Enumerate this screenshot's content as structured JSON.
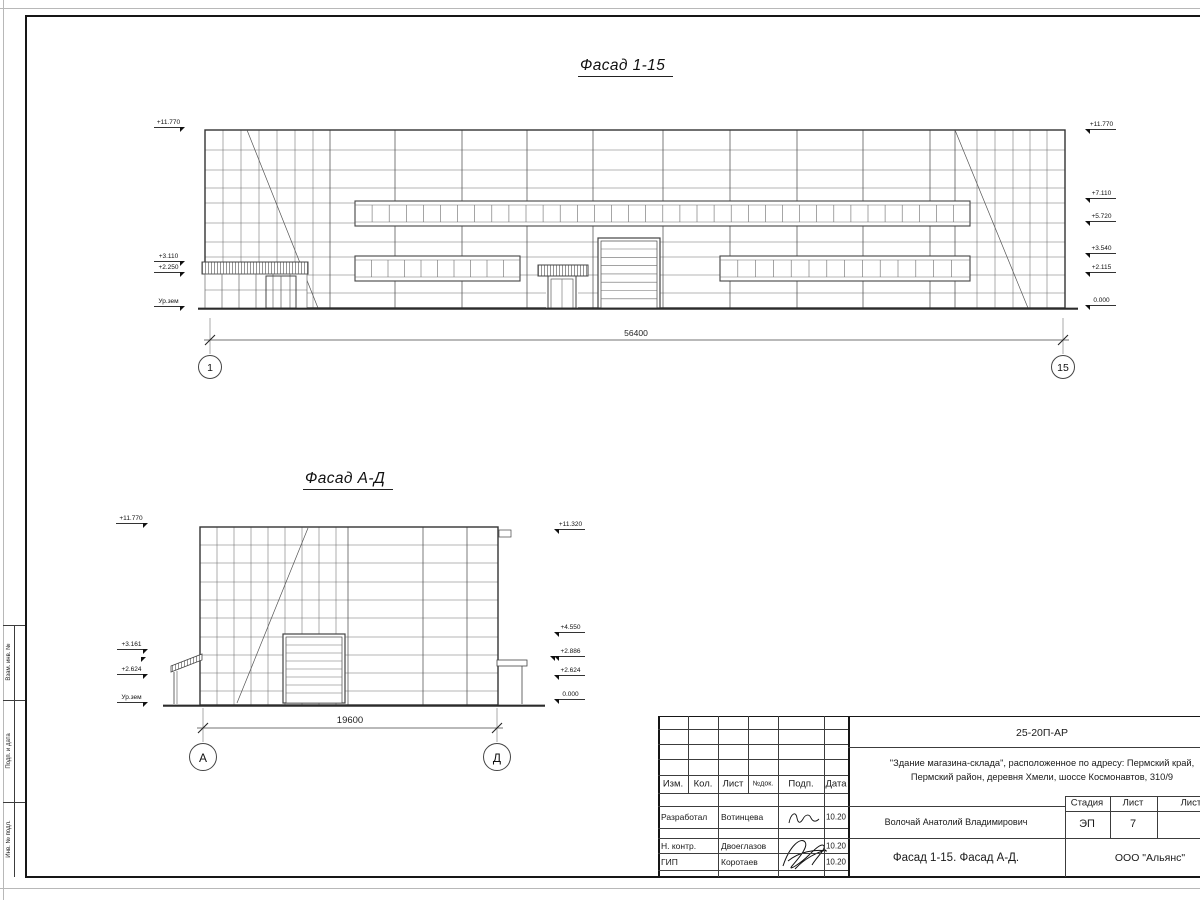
{
  "f1": {
    "title": "Фасад 1-15",
    "dim": "56400",
    "axis_left": "1",
    "axis_right": "15",
    "levels_left": [
      "+11.770",
      "+3.110",
      "+2.250",
      "Ур.зем"
    ],
    "levels_right": [
      "+11.770",
      "+7.110",
      "+5.720",
      "+3.540",
      "+2.115",
      "0.000"
    ]
  },
  "fad": {
    "title": "Фасад А-Д",
    "dim": "19600",
    "axis_left": "А",
    "axis_right": "Д",
    "levels_left": [
      "+11.770",
      "+3.161",
      "+2.624",
      "Ур.зем"
    ],
    "levels_right": [
      "+11.320",
      "+4.550",
      "+2.886",
      "+2.624",
      "0.000"
    ]
  },
  "stamp": {
    "labels": [
      "Взам. инв. №",
      "Подп. и дата",
      "Инв. № подл."
    ]
  },
  "tb": {
    "code": "25-20П-АР",
    "project1": "\"Здание магазина-склада\", расположенное по адресу: Пермский край,",
    "project2": "Пермский район, деревня Хмели, шоссе Космонавтов, 310/9",
    "cols": {
      "izm": "Изм.",
      "kol": "Кол.",
      "list": "Лист",
      "ndok": "№док.",
      "podp": "Подп.",
      "data": "Дата"
    },
    "rows": [
      {
        "role": "Разработал",
        "name": "Вотинцева",
        "date": "10.20"
      },
      {
        "role": "Н. контр.",
        "name": "Двоеглазов",
        "date": "10.20"
      },
      {
        "role": "ГИП",
        "name": "Коротаев",
        "date": "10.20"
      }
    ],
    "author": "Волочай Анатолий Владимирович",
    "stage_label": "Стадия",
    "sheet_label": "Лист",
    "sheets_label": "Листов",
    "stage": "ЭП",
    "sheet": "7",
    "sheet_title": "Фасад 1-15. Фасад А-Д.",
    "company": "ООО \"Альянс\""
  }
}
